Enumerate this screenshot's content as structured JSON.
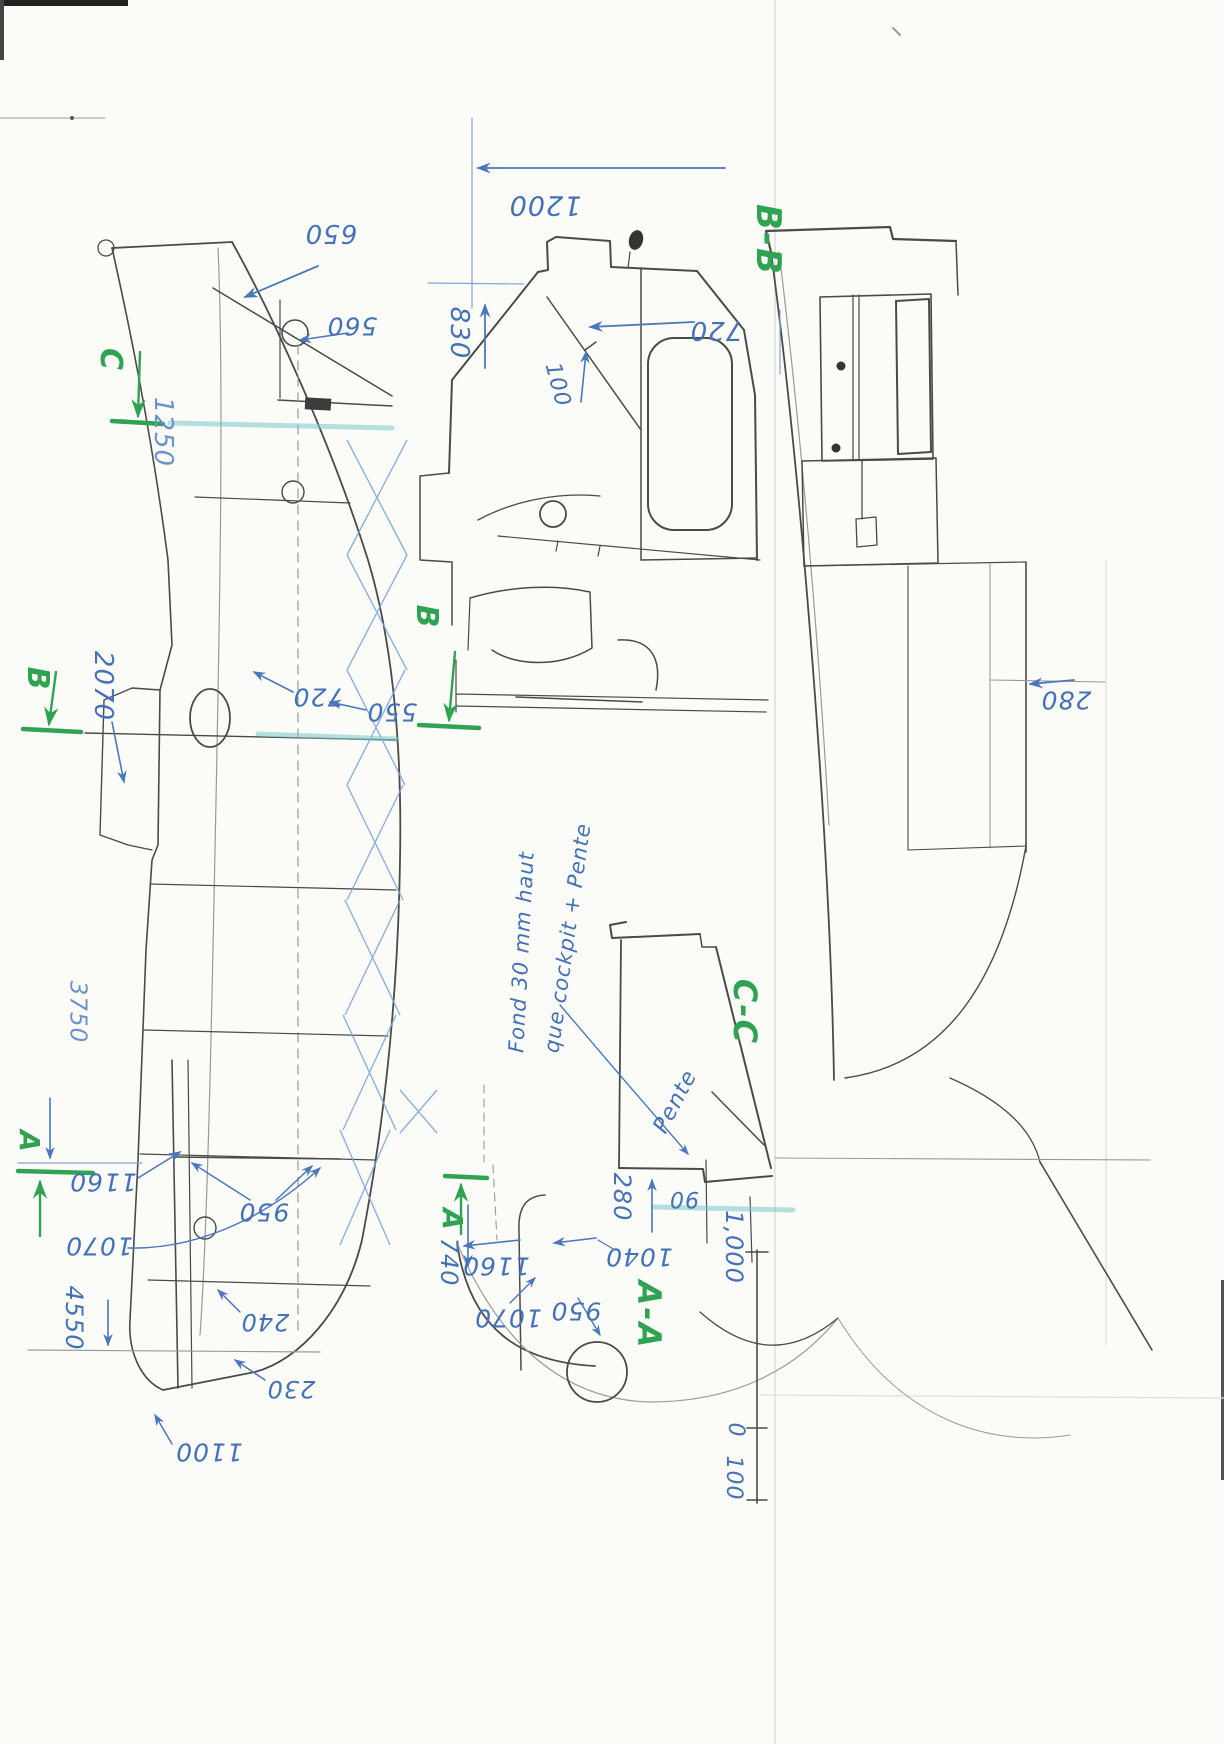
{
  "document": {
    "kind": "hand-drawn boat construction drawing (scanned sheet, views rotated)"
  },
  "palette": {
    "ink": "#4472b8",
    "green": "#2fa352",
    "pencil": "#4a4a4a",
    "highlight": "#78c8c8",
    "paper": "#fbfbf8"
  },
  "section_labels": [
    "B-B",
    "C-C",
    "A-A"
  ],
  "station_letters": [
    "C",
    "B",
    "B",
    "A",
    "A"
  ],
  "note": {
    "line1": "Fond 30 mm haut",
    "line2": "que cockpit + Pente",
    "slope_word": "Pente"
  },
  "scale_bar": {
    "values": [
      "1,000",
      "100",
      "0"
    ]
  },
  "labels": [
    {
      "name": "dim-1200",
      "text": "1200",
      "x": 545,
      "y": 205,
      "rot": 180,
      "fs": 27,
      "c": "ink"
    },
    {
      "name": "dim-830",
      "text": "830",
      "x": 459,
      "y": 333,
      "rot": 90,
      "fs": 26,
      "c": "ink"
    },
    {
      "name": "dim-100",
      "text": "100",
      "x": 557,
      "y": 385,
      "rot": 75,
      "fs": 22,
      "c": "ink"
    },
    {
      "name": "dim-720-bb",
      "text": "720",
      "x": 716,
      "y": 330,
      "rot": 180,
      "fs": 26,
      "c": "ink"
    },
    {
      "name": "dim-650",
      "text": "650",
      "x": 331,
      "y": 233,
      "rot": 180,
      "fs": 26,
      "c": "ink"
    },
    {
      "name": "dim-560",
      "text": "560",
      "x": 352,
      "y": 326,
      "rot": 180,
      "fs": 25,
      "c": "ink"
    },
    {
      "name": "dim-1250",
      "text": "1250",
      "x": 163,
      "y": 432,
      "rot": 90,
      "fs": 26,
      "c": "ink2"
    },
    {
      "name": "dim-2070",
      "text": "2070",
      "x": 103,
      "y": 686,
      "rot": 90,
      "fs": 26,
      "c": "ink"
    },
    {
      "name": "dim-720-side",
      "text": "720",
      "x": 318,
      "y": 697,
      "rot": 180,
      "fs": 25,
      "c": "ink"
    },
    {
      "name": "dim-550-side",
      "text": "550",
      "x": 392,
      "y": 712,
      "rot": 180,
      "fs": 25,
      "c": "ink"
    },
    {
      "name": "dim-280-cabin",
      "text": "280",
      "x": 1066,
      "y": 700,
      "rot": 180,
      "fs": 25,
      "c": "ink"
    },
    {
      "name": "note-line1",
      "text": "Fond 30 mm haut",
      "x": 522,
      "y": 952,
      "rot": -87,
      "fs": 21,
      "c": "ink"
    },
    {
      "name": "note-line2",
      "text": "que cockpit + Pente",
      "x": 568,
      "y": 938,
      "rot": -82,
      "fs": 21,
      "c": "ink"
    },
    {
      "name": "note-pente",
      "text": "Pente",
      "x": 676,
      "y": 1102,
      "rot": -62,
      "fs": 22,
      "c": "ink"
    },
    {
      "name": "dim-280-cc",
      "text": "280",
      "x": 622,
      "y": 1197,
      "rot": 90,
      "fs": 24,
      "c": "ink"
    },
    {
      "name": "dim-90",
      "text": "90",
      "x": 684,
      "y": 1198,
      "rot": 180,
      "fs": 22,
      "c": "ink"
    },
    {
      "name": "dim-3750",
      "text": "3750",
      "x": 77,
      "y": 1012,
      "rot": 90,
      "fs": 23,
      "c": "ink2"
    },
    {
      "name": "dim-1160-side",
      "text": "1160",
      "x": 103,
      "y": 1182,
      "rot": 180,
      "fs": 25,
      "c": "ink"
    },
    {
      "name": "dim-1070-side",
      "text": "1070",
      "x": 99,
      "y": 1246,
      "rot": 180,
      "fs": 25,
      "c": "ink"
    },
    {
      "name": "dim-950-side",
      "text": "950",
      "x": 264,
      "y": 1212,
      "rot": 180,
      "fs": 25,
      "c": "ink"
    },
    {
      "name": "dim-4550",
      "text": "4550",
      "x": 74,
      "y": 1318,
      "rot": 90,
      "fs": 24,
      "c": "ink"
    },
    {
      "name": "dim-240",
      "text": "240",
      "x": 265,
      "y": 1322,
      "rot": 180,
      "fs": 24,
      "c": "ink"
    },
    {
      "name": "dim-230",
      "text": "230",
      "x": 291,
      "y": 1389,
      "rot": 180,
      "fs": 24,
      "c": "ink"
    },
    {
      "name": "dim-1100",
      "text": "1100",
      "x": 209,
      "y": 1452,
      "rot": 180,
      "fs": 25,
      "c": "ink"
    },
    {
      "name": "dim-1160-aa",
      "text": "1160",
      "x": 496,
      "y": 1266,
      "rot": 180,
      "fs": 25,
      "c": "ink"
    },
    {
      "name": "dim-1040-aa",
      "text": "1040",
      "x": 639,
      "y": 1257,
      "rot": 180,
      "fs": 25,
      "c": "ink"
    },
    {
      "name": "dim-740",
      "text": "740",
      "x": 449,
      "y": 1262,
      "rot": 90,
      "fs": 24,
      "c": "ink"
    },
    {
      "name": "dim-1070-aa",
      "text": "1070",
      "x": 508,
      "y": 1318,
      "rot": 180,
      "fs": 25,
      "c": "ink"
    },
    {
      "name": "dim-950-aa",
      "text": "950",
      "x": 576,
      "y": 1311,
      "rot": 180,
      "fs": 25,
      "c": "ink"
    },
    {
      "name": "scale-1000",
      "text": "1,000",
      "x": 734,
      "y": 1247,
      "rot": 90,
      "fs": 24,
      "c": "ink"
    },
    {
      "name": "scale-0",
      "text": "0",
      "x": 735,
      "y": 1430,
      "rot": 90,
      "fs": 22,
      "c": "ink"
    },
    {
      "name": "scale-100",
      "text": "100",
      "x": 733,
      "y": 1478,
      "rot": 90,
      "fs": 22,
      "c": "ink"
    },
    {
      "name": "section-label-bb",
      "text": "B-B",
      "x": 768,
      "y": 240,
      "rot": 90,
      "fs": 34,
      "c": "green"
    },
    {
      "name": "section-label-cc",
      "text": "C-C",
      "x": 745,
      "y": 1012,
      "rot": 90,
      "fs": 32,
      "c": "green"
    },
    {
      "name": "section-label-aa",
      "text": "A-A",
      "x": 649,
      "y": 1315,
      "rot": 90,
      "fs": 32,
      "c": "green"
    },
    {
      "name": "station-letter-c",
      "text": "C",
      "x": 110,
      "y": 360,
      "rot": 90,
      "fs": 30,
      "c": "green"
    },
    {
      "name": "station-letter-b-left",
      "text": "B",
      "x": 37,
      "y": 679,
      "rot": 90,
      "fs": 30,
      "c": "green"
    },
    {
      "name": "station-letter-b-mid",
      "text": "B",
      "x": 426,
      "y": 617,
      "rot": 90,
      "fs": 30,
      "c": "green"
    },
    {
      "name": "station-letter-a-left",
      "text": "A",
      "x": 29,
      "y": 1142,
      "rot": 90,
      "fs": 28,
      "c": "green"
    },
    {
      "name": "station-letter-a-right",
      "text": "A",
      "x": 452,
      "y": 1220,
      "rot": 90,
      "fs": 28,
      "c": "green"
    }
  ]
}
